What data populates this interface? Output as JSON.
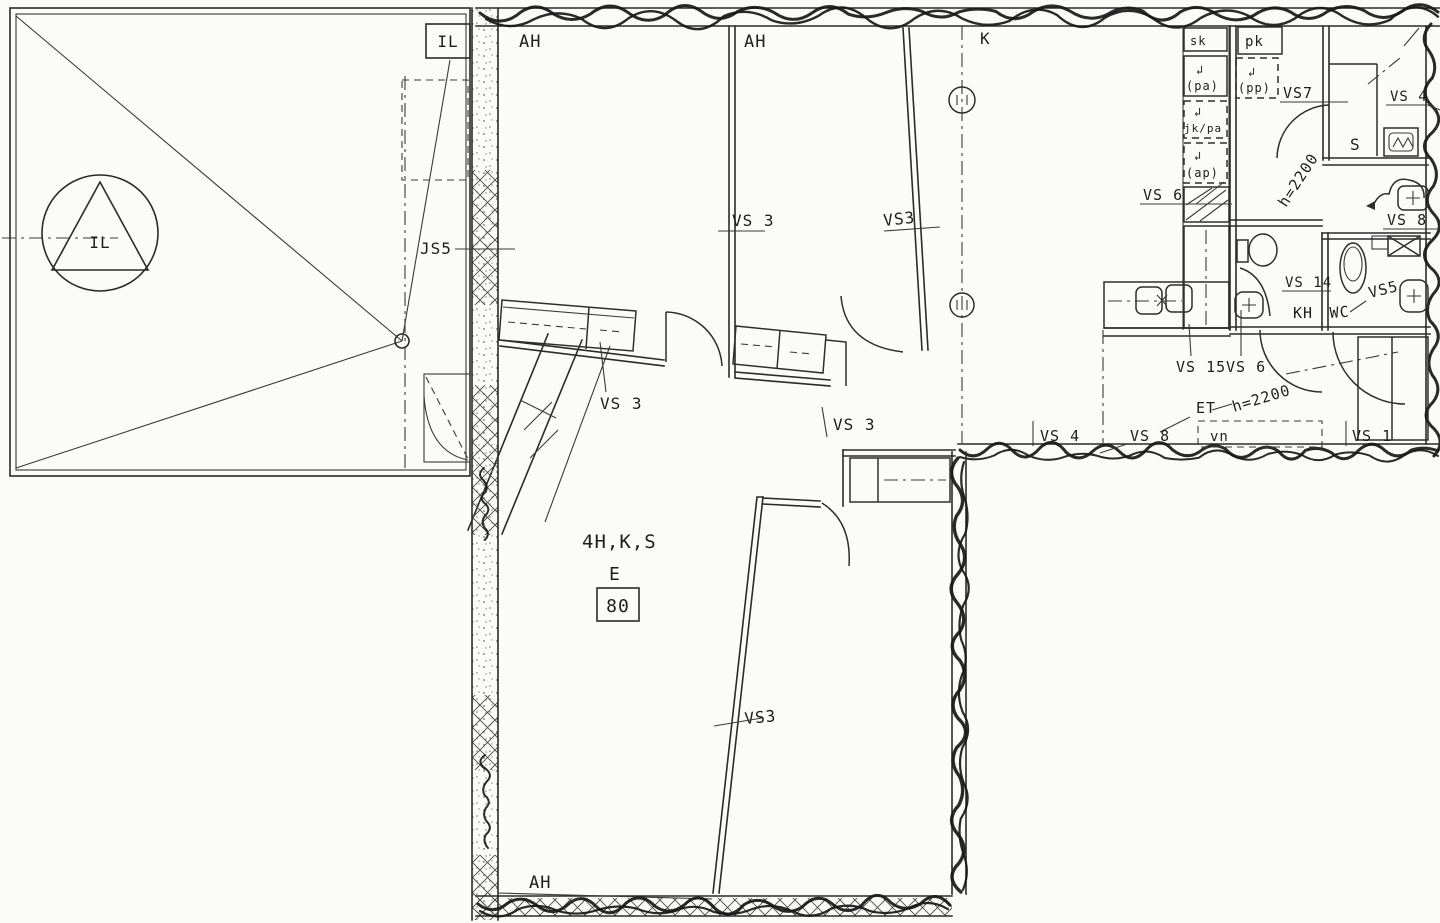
{
  "plan": {
    "apartment": {
      "type_code": "4H,K,S",
      "staircase_letter": "E",
      "unit_number": "80"
    },
    "labels": {
      "il": "IL",
      "ah": "AH",
      "k": "K",
      "s": "S",
      "kh": "KH",
      "wc": "WC",
      "et": "ET",
      "js5": "JS5",
      "vs1": "VS 1",
      "vs3": "VS 3",
      "vs3t": "VS3",
      "vs4": "VS 4",
      "vs5": "VS5",
      "vs6": "VS 6",
      "vs7": "VS7",
      "vs8": "VS 8",
      "vs14": "VS 14",
      "vs15": "VS 15",
      "h2200": "h=2200",
      "sk": "sk",
      "pk": "pk",
      "pa": "(pa)",
      "pp": "(pp)",
      "jkpa": "jk/pa",
      "ap": "(ap)",
      "vn": "vn",
      "hook_arrow": "↲"
    },
    "icons": {
      "supply_air": "circle-with-triangle",
      "sauna_stove": "box-with-zigzag",
      "duct_shaft": "crossed-box",
      "kitchen_sink": "double-basin",
      "toilet": "oval-bowl",
      "washbasin": "rounded-square-with-cross",
      "structural_column": "small-circle-on-dashdot-line"
    },
    "colors": {
      "ink": "#1d1d1d",
      "paper": "#fbfbf9"
    }
  }
}
